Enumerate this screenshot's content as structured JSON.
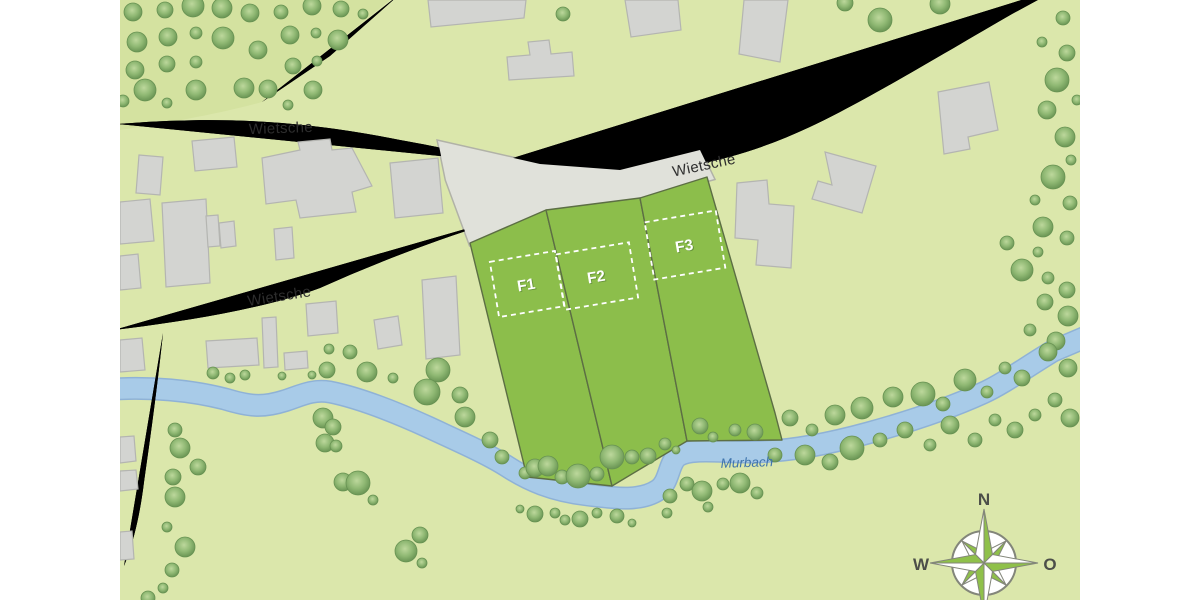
{
  "map": {
    "labels": {
      "road_upper": "Wietsche",
      "road_main": "Wietsche",
      "road_lower": "Wietsche",
      "stream": "Murbach"
    },
    "parcels": [
      {
        "id": "F1",
        "label": "F1"
      },
      {
        "id": "F2",
        "label": "F2"
      },
      {
        "id": "F3",
        "label": "F3"
      }
    ],
    "compass": {
      "north": "N",
      "west": "W",
      "east": "O"
    },
    "colors": {
      "background": "#dbe7ab",
      "forest": "#d4e2a0",
      "road_fill": "#e0e1da",
      "road_stroke": "#b1b2a7",
      "building_fill": "#d3d4d1",
      "building_stroke": "#b4b5b1",
      "stream_fill": "#a8cbe8",
      "stream_stroke": "#8fb2d6",
      "parcel_fill": "#8cbe4b",
      "parcel_stroke": "#5c6e44",
      "dashed_box": "#ffffff",
      "parcel_label": "#ffffff",
      "road_label": "#2d2d2d",
      "stream_label": "#3f74ac",
      "compass_green": "#8fc04a",
      "compass_outline": "#83867a",
      "compass_label": "#4c4f49",
      "tree_dark": "#679252",
      "tree_mid": "#8fb873",
      "tree_light": "#bdd89c"
    }
  }
}
